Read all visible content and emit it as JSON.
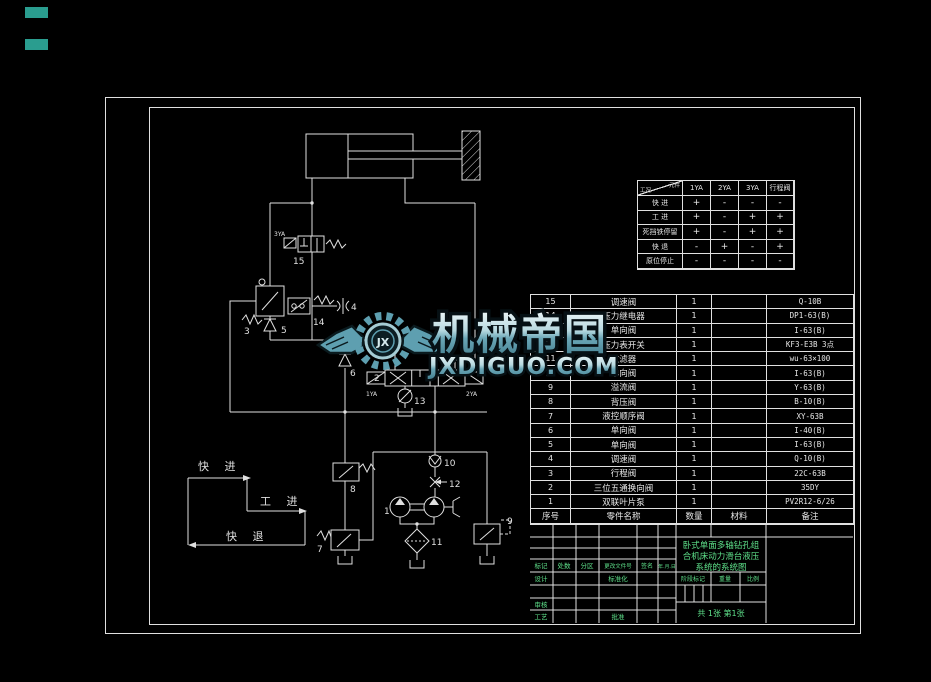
{
  "colors": {
    "line": "#e0e0e0",
    "green": "#5ee08a",
    "teal_box": "#2a9d8f",
    "watermark_teal": "#5e9fb0"
  },
  "watermark": {
    "brand": "机械帝国",
    "domain": "JXDIGUO.COM",
    "logo_text": "JX"
  },
  "action_table": {
    "corner": {
      "top": "元件",
      "bottom": "工况"
    },
    "columns": [
      "1YA",
      "2YA",
      "3YA",
      "行程阀"
    ],
    "rows": [
      {
        "label": "快  进",
        "values": [
          "+",
          "-",
          "-",
          "-"
        ]
      },
      {
        "label": "工  进",
        "values": [
          "+",
          "-",
          "+",
          "+"
        ]
      },
      {
        "label": "死挡铁停留",
        "values": [
          "+",
          "-",
          "+",
          "+"
        ]
      },
      {
        "label": "快  退",
        "values": [
          "-",
          "+",
          "-",
          "+"
        ]
      },
      {
        "label": "原位停止",
        "values": [
          "-",
          "-",
          "-",
          "-"
        ]
      }
    ]
  },
  "bom": {
    "headers": [
      "序号",
      "零件名称",
      "数量",
      "材料",
      "备注"
    ],
    "rows": [
      [
        "15",
        "调速阀",
        "1",
        "",
        "Q-10B"
      ],
      [
        "14",
        "压力继电器",
        "1",
        "",
        "DP1-63(B)"
      ],
      [
        "13",
        "单向阀",
        "1",
        "",
        "I-63(B)"
      ],
      [
        "12",
        "压力表开关",
        "1",
        "",
        "KF3-E3B 3点"
      ],
      [
        "11",
        "过滤器",
        "1",
        "",
        "wu-63×100"
      ],
      [
        "10",
        "单向阀",
        "1",
        "",
        "I-63(B)"
      ],
      [
        "9",
        "溢流阀",
        "1",
        "",
        "Y-63(B)"
      ],
      [
        "8",
        "背压阀",
        "1",
        "",
        "B-10(B)"
      ],
      [
        "7",
        "液控顺序阀",
        "1",
        "",
        "XY-63B"
      ],
      [
        "6",
        "单向阀",
        "1",
        "",
        "I-40(B)"
      ],
      [
        "5",
        "单向阀",
        "1",
        "",
        "I-63(B)"
      ],
      [
        "4",
        "调速阀",
        "1",
        "",
        "Q-10(B)"
      ],
      [
        "3",
        "行程阀",
        "1",
        "",
        "22C-63B"
      ],
      [
        "2",
        "三位五通换向阀",
        "1",
        "",
        "35DY"
      ],
      [
        "1",
        "双联叶片泵",
        "1",
        "",
        "PV2R12-6/26"
      ]
    ]
  },
  "title_block": {
    "title_lines": [
      "卧式单面多轴钻孔组",
      "合机床动力滑台液压",
      "系统的系统图"
    ],
    "labels": {
      "biaoji": "标记",
      "chushu": "处数",
      "fenqu": "分区",
      "genggai": "更改文件号",
      "qianming": "签名",
      "riqi": "年.月.日",
      "sheji": "设计",
      "biaozhunhua": "标准化",
      "shenhe": "审核",
      "gongyi": "工艺",
      "pizhun": "批准",
      "jieduan": "阶段标记",
      "zhongliang": "重量",
      "bili": "比例",
      "sheets": "共 1张 第1张"
    }
  },
  "schematic": {
    "cycle": {
      "fast_forward": "快 进",
      "work_feed": "工 进",
      "fast_return": "快 退"
    },
    "labels": {
      "n1": "1",
      "n2": "2",
      "n3": "3",
      "n4": "4",
      "n5": "5",
      "n6": "6",
      "n7": "7",
      "n8": "8",
      "n9": "9",
      "n10": "10",
      "n11": "11",
      "n12": "12",
      "n13": "13",
      "n14": "14",
      "n15": "15",
      "ya1": "1YA",
      "ya2": "2YA",
      "ya3": "3YA"
    }
  }
}
